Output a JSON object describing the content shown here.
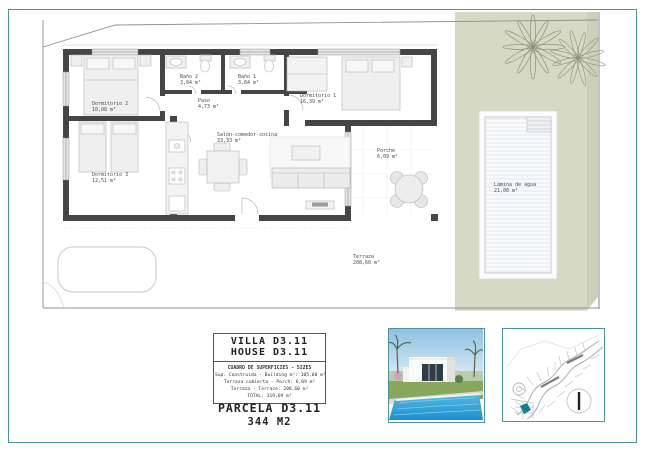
{
  "page": {
    "border_color": "#4e929b",
    "garden_color": "#d6dac5",
    "wall_color": "#454545",
    "highlight_parcel_color": "#17808e"
  },
  "floor_plan": {
    "rooms": {
      "dormitorio2": {
        "name": "Dormitorio 2",
        "area": "10,08 m²"
      },
      "dormitorio3": {
        "name": "Dormitorio 3",
        "area": "12,51 m²"
      },
      "bano2": {
        "name": "Baño 2",
        "area": "3,84 m²"
      },
      "bano1": {
        "name": "Baño 1",
        "area": "3,84 m²"
      },
      "paso": {
        "name": "Paso",
        "area": "4,73 m²"
      },
      "salon": {
        "name": "Salón-comedor-cocina",
        "area": "33,33 m²"
      },
      "dormitorio1": {
        "name": "Dormitorio 1",
        "area": "16,39 m²"
      },
      "porche": {
        "name": "Porche",
        "area": "6,09 m²"
      },
      "terraza": {
        "name": "Terraza",
        "area": "208,60 m²"
      },
      "lamina": {
        "name": "Lámina de agua",
        "area": "21,00 m²"
      }
    }
  },
  "title_block": {
    "villa": "VILLA D3.11",
    "house": "HOUSE D3.11",
    "sizes_header": "CUADRO DE SUPERFICIES - SIZES",
    "sizes_lines": [
      "Sup. Construida - Building m²: 105,00 m²",
      "Terraza cubierta - Porch: 6,09 m²",
      "Terraza - Terrace: 208,60 m²",
      "TOTAL: 319,69 m²"
    ],
    "parcel": "PARCELA D3.11",
    "parcel_area": "344 M2"
  }
}
